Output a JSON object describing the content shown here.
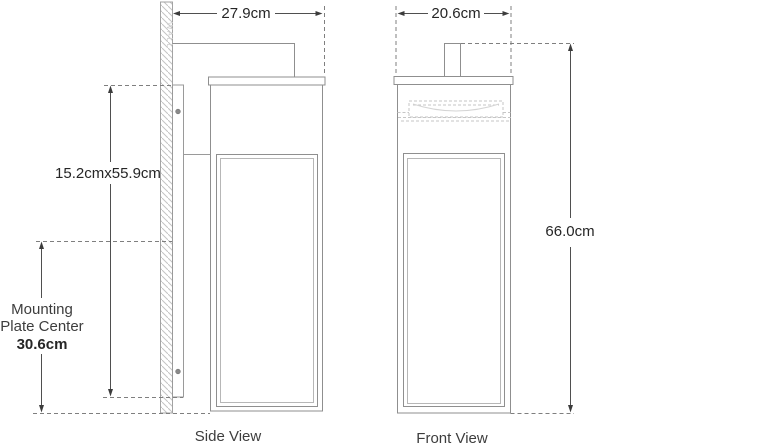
{
  "side_view": {
    "label": "Side View",
    "top_width": "27.9cm",
    "backplate_size": "15.2cmx55.9cm",
    "mounting_center_line1": "Mounting",
    "mounting_center_line2": "Plate Center",
    "mounting_center_value": "30.6cm",
    "wall_label": "WALL"
  },
  "front_view": {
    "label": "Front View",
    "top_width": "20.6cm",
    "height": "66.0cm"
  },
  "colors": {
    "background": "#ffffff",
    "fixture_outline": "#8f8f8f",
    "inner_panel": "#b7b7b7",
    "dimension_lines": "#4f4f4f",
    "dashed_lines": "#7f7f7f",
    "hatch": "#c4c4c4",
    "text": "#262626"
  }
}
